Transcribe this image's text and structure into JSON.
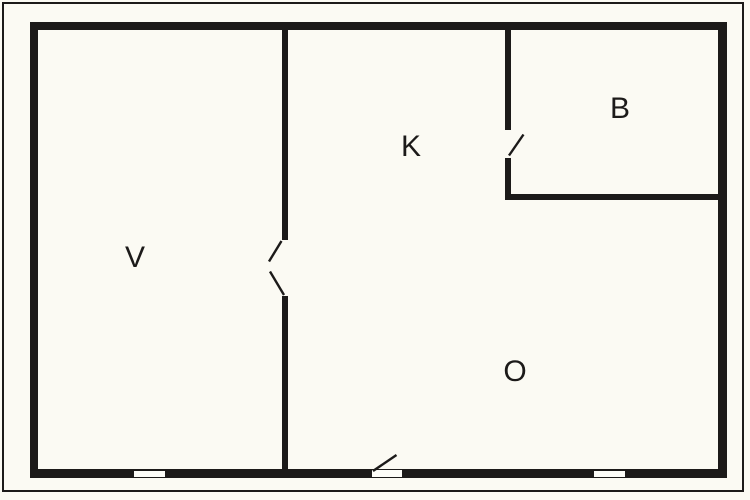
{
  "floor_plan": {
    "type": "floor-plan-diagram",
    "rooms": [
      {
        "id": "v",
        "label": "V"
      },
      {
        "id": "k",
        "label": "K"
      },
      {
        "id": "b",
        "label": "B"
      },
      {
        "id": "o",
        "label": "O"
      }
    ],
    "features": {
      "windows": 2,
      "doors": 3
    },
    "colors": {
      "wall": "#1c1a19",
      "background": "#fbfaf3"
    }
  }
}
